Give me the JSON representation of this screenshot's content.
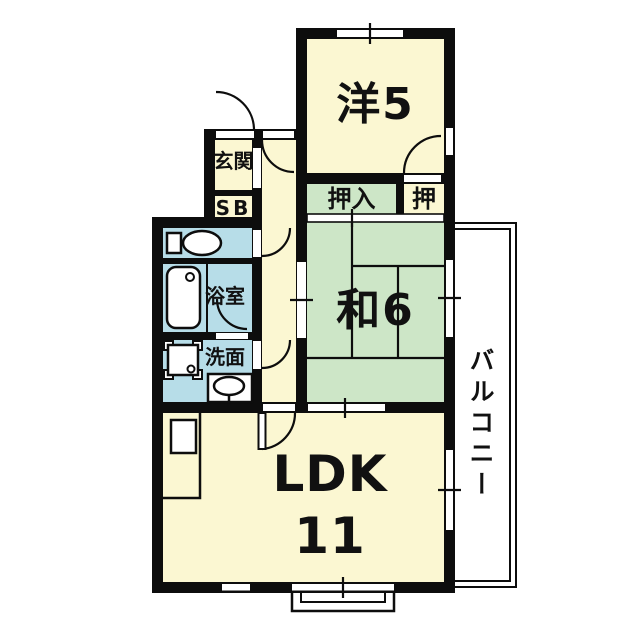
{
  "plan": {
    "type": "apartment-floorplan",
    "rooms": {
      "western": "洋5",
      "entrance": "玄関",
      "shoebox": "SB",
      "closet_main": "押入",
      "closet_side": "押",
      "japanese": "和6",
      "bath": "浴室",
      "washroom": "洗面",
      "ldk": "LDK",
      "ldk_size": "11",
      "balcony": "バルコニー"
    },
    "colors": {
      "room_cream": "#FBF7D2",
      "tatami_green": "#CDE6C7",
      "wet_blue": "#B7DDE8",
      "wall": "#0D0D0D",
      "background": "#FFFFFF"
    }
  }
}
